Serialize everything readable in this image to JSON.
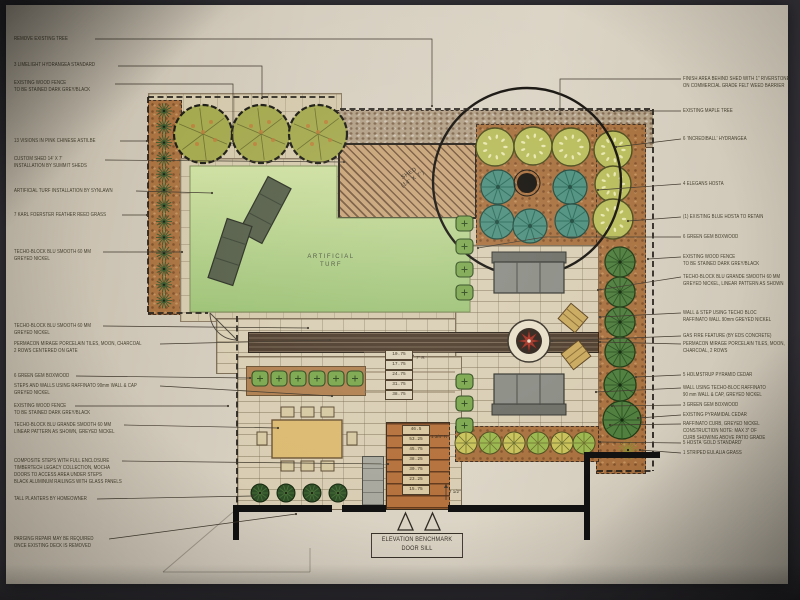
{
  "plan": {
    "area_labels": {
      "turf_line1": "ARTIFICIAL",
      "turf_line2": "TURF",
      "shed_line1": "SHED",
      "shed_line2": "(14' X 7')"
    },
    "benchmark": {
      "line1": "ELEVATION BENCHMARK",
      "line2": "DOOR SILL"
    },
    "wall_step_elevations": [
      "10.75",
      "17.75",
      "24.75",
      "31.75",
      "38.75"
    ],
    "wall_riser_note": "7\" R",
    "deck_step_elevations": [
      "46.5",
      "53.25",
      "45.75",
      "38.25",
      "30.75",
      "23.25",
      "15.75"
    ],
    "deck_riser_note": "1 3/4\" R",
    "deck_riser_note2": "7 1/2\"",
    "colors": {
      "photo_background": "#36343a",
      "paper": "#d6cebf",
      "ink": "#3f382c",
      "mulch": "#a9713f",
      "turf": "#b7d189",
      "paving": "#d9ceb4",
      "porcelain_tile": "#4e3d2d",
      "composite_steps": "#b5713c",
      "hydrangea": "#b9bd5c",
      "hosta_teal": "#4e8f7e",
      "cedar_green": "#4f7e3e",
      "boxwood_green": "#7ca74e",
      "fire_star_red": "#a33426"
    }
  },
  "annotations": {
    "left": [
      {
        "lines": [
          "REMOVE EXISTING TREE"
        ]
      },
      {
        "lines": [
          "3 LIMELIGHT HYDRANGEA STANDARD"
        ]
      },
      {
        "lines": [
          "EXISTING WOOD FENCE",
          "TO BE STAINED DARK GREY/BLACK"
        ]
      },
      {
        "lines": [
          "13 VISIONS IN PINK CHINESE ASTILBE"
        ]
      },
      {
        "lines": [
          "CUSTOM SHED 14' X 7'",
          "INSTALLATION BY SUMMIT SHEDS"
        ]
      },
      {
        "lines": [
          "ARTIFICIAL TURF INSTALLATION BY SYNLAWN"
        ]
      },
      {
        "lines": [
          "7 KARL FOERSTER FEATHER REED GRASS"
        ]
      },
      {
        "lines": [
          "TECHO-BLOCK BLU SMOOTH 60 MM",
          "GREYED NICKEL"
        ]
      },
      {
        "lines": [
          "TECHO-BLOCK BLU SMOOTH 60 MM",
          "GREYED NICKEL"
        ]
      },
      {
        "lines": [
          "PERMACON MIRAGE PORCELAIN TILES, MOON, CHARCOAL",
          "2 ROWS CENTERED ON GATE"
        ]
      },
      {
        "lines": [
          "6 GREEN GEM BOXWOOD"
        ]
      },
      {
        "lines": [
          "STEPS AND WALLS USING RAFFINATO 90mm WALL & CAP",
          "GREYED NICKEL"
        ]
      },
      {
        "lines": [
          "EXISTING WOOD FENCE",
          "TO BE STAINED DARK GREY/BLACK"
        ]
      },
      {
        "lines": [
          "TECHO-BLOCK BLU GRANDE SMOOTH 60 MM",
          "LINEAR PATTERN AS SHOWN, GREYED NICKEL"
        ]
      },
      {
        "lines": [
          "COMPOSITE STEPS WITH FULL ENCLOSURE",
          "TIMBERTECH LEGACY COLLECTION, MOCHA",
          "DOORS TO ACCESS AREA UNDER STEPS",
          "BLACK ALUMINUM RAILINGS WITH GLASS PANELS"
        ]
      },
      {
        "lines": [
          "TALL PLANTERS BY HOMEOWNER"
        ]
      },
      {
        "lines": [
          "PARGING REPAIR MAY BE REQUIRED",
          "ONCE EXISTING DECK IS REMOVED"
        ]
      }
    ],
    "right": [
      {
        "lines": [
          "FINISH AREA BEHIND SHED WITH 1\" RIVERSTONE",
          "ON COMMERCIAL GRADE FELT WEED BARRIER"
        ]
      },
      {
        "lines": [
          "EXISTING MAPLE TREE"
        ]
      },
      {
        "lines": [
          "6 'INCREDIBALL' HYDRANGEA"
        ]
      },
      {
        "lines": [
          "4 ELEGANS HOSTA"
        ]
      },
      {
        "lines": [
          "(1) EXISTING BLUE HOSTA TO RETAIN"
        ]
      },
      {
        "lines": [
          "6 GREEN GEM BOXWOOD"
        ]
      },
      {
        "lines": [
          "EXISTING WOOD FENCE",
          "TO BE STAINED DARK GREY/BLACK"
        ]
      },
      {
        "lines": [
          "TECHO-BLOCK BLU GRANDE SMOOTH 60 MM",
          "GREYED NICKEL, LINEAR PATTERN AS SHOWN"
        ]
      },
      {
        "lines": [
          "WALL & STEP USING TECHO BLOC",
          "RAFFINATO WALL 90mm GREYED NICKEL"
        ]
      },
      {
        "lines": [
          "GAS FIRE FEATURE (BY EDS CONCRETE)"
        ]
      },
      {
        "lines": [
          "PERMACON MIRAGE PORCELAIN TILES, MOON,",
          "CHARCOAL, 2 ROWS"
        ]
      },
      {
        "lines": [
          "5 HOLMSTRUP PYRAMID CEDAR"
        ]
      },
      {
        "lines": [
          "WALL USING TECHO-BLOC RAFFINATO",
          "90 mm WALL & CAP, GREYED NICKEL"
        ]
      },
      {
        "lines": [
          "3 GREEN GEM BOXWOOD"
        ]
      },
      {
        "lines": [
          "EXISTING PYRAMIDAL CEDAR"
        ]
      },
      {
        "lines": [
          "RAFFINATO CURB, GREYED NICKEL",
          "CONSTRUCTION NOTE: MAX 3\" OF",
          "CURB SHOWING ABOVE PATIO GRADE"
        ]
      },
      {
        "lines": [
          "5 HOSTA 'GOLD STANDARD'"
        ]
      },
      {
        "lines": [
          "1 STRIPED EULALIA GRASS"
        ]
      }
    ]
  }
}
